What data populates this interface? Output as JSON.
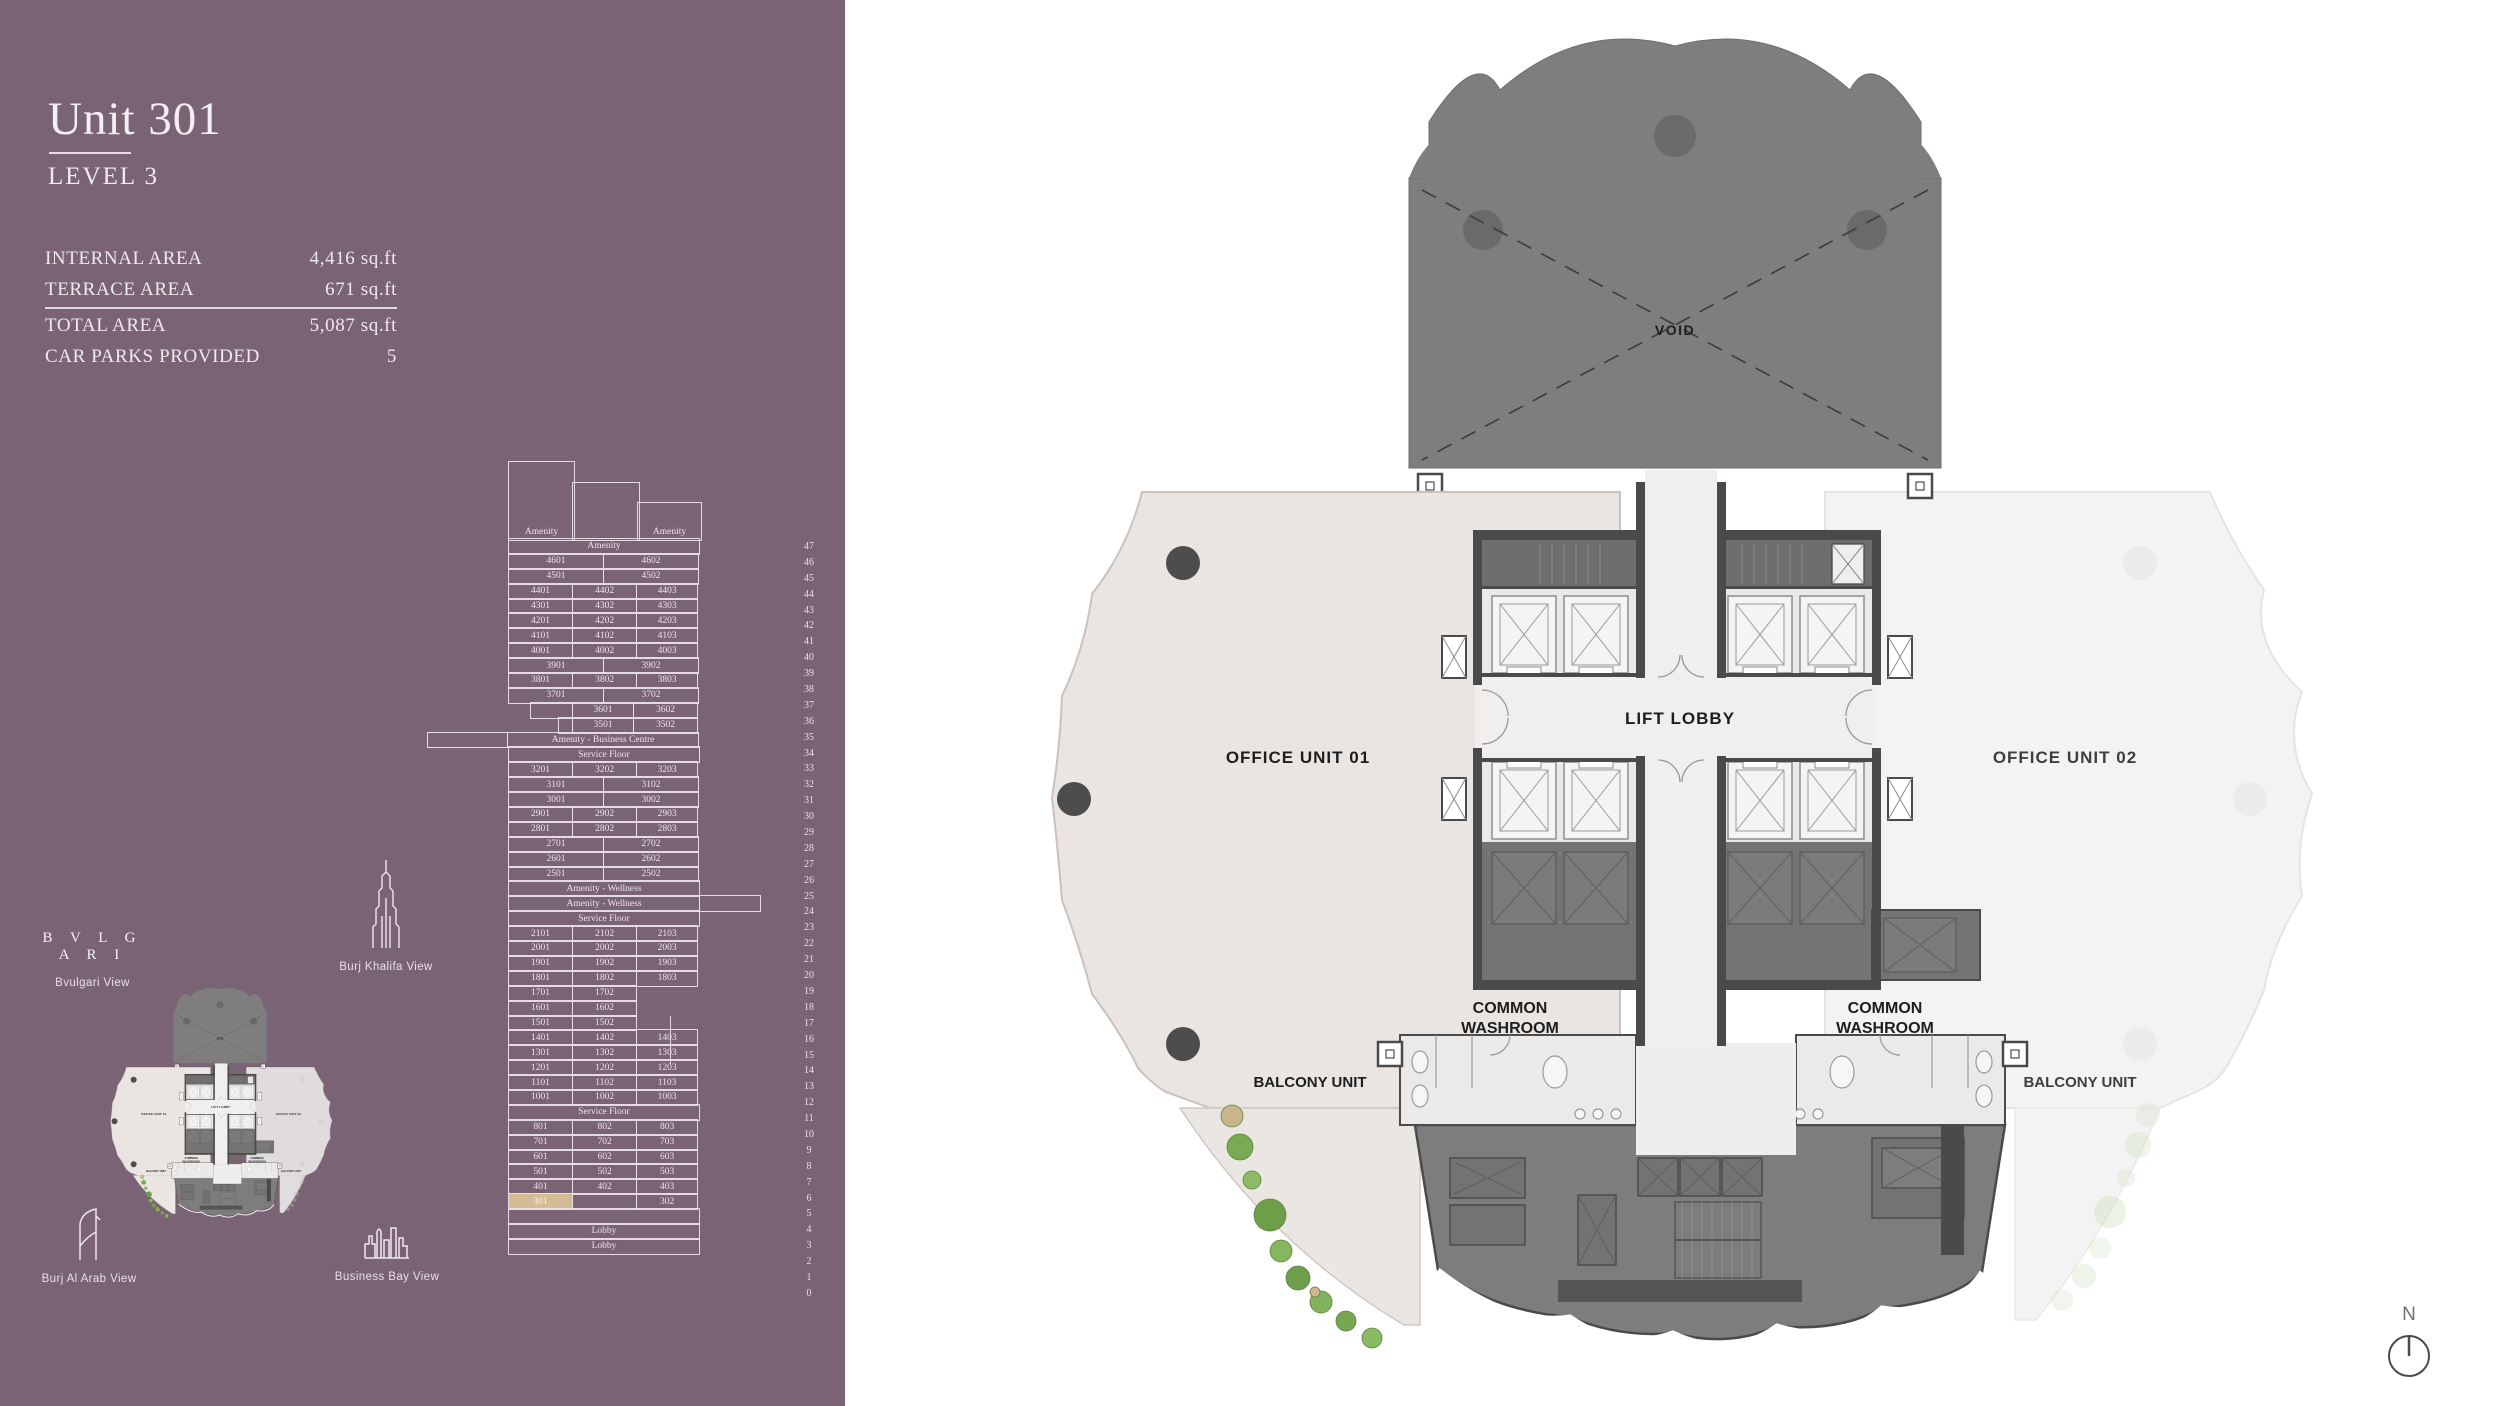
{
  "sidebar": {
    "bg_color": "#7a6374",
    "title": "Unit 301",
    "subtitle": "LEVEL 3",
    "stats": [
      {
        "label": "INTERNAL AREA",
        "value": "4,416 sq.ft"
      },
      {
        "label": "TERRACE AREA",
        "value": "671 sq.ft"
      },
      {
        "label": "TOTAL AREA",
        "value": "5,087 sq.ft"
      },
      {
        "label": "CAR PARKS PROVIDED",
        "value": "5"
      }
    ],
    "views": {
      "bvlgari_logo": "B V L G A R I",
      "bvlgari": "Bvulgari View",
      "burj_khalifa": "Burj Khalifa View",
      "burj_al_arab": "Burj Al Arab View",
      "business_bay": "Business Bay View"
    },
    "stack": {
      "highlight_color": "#d3bb95",
      "highlighted_unit": "301",
      "crown_left": "Amenity",
      "crown_right": "Amenity",
      "stub": {
        "x": 162,
        "from_row": 30,
        "rows": 3
      },
      "rows": [
        {
          "n": "47",
          "c": [
            {
              "t": "Amenity",
              "w": 100,
              "lb": 1
            }
          ]
        },
        {
          "n": "46",
          "c": [
            {
              "t": "4601",
              "w": 50
            },
            {
              "t": "4602",
              "w": 50
            }
          ]
        },
        {
          "n": "45",
          "c": [
            {
              "t": "4501",
              "w": 50
            },
            {
              "t": "4502",
              "w": 50
            }
          ]
        },
        {
          "n": "44",
          "c": [
            {
              "t": "4401",
              "w": 33.9
            },
            {
              "t": "4402",
              "w": 33.9
            },
            {
              "t": "4403",
              "w": 32.2
            }
          ]
        },
        {
          "n": "43",
          "c": [
            {
              "t": "4301",
              "w": 33.9
            },
            {
              "t": "4302",
              "w": 33.9
            },
            {
              "t": "4303",
              "w": 32.2
            }
          ]
        },
        {
          "n": "42",
          "c": [
            {
              "t": "4201",
              "w": 33.9
            },
            {
              "t": "4202",
              "w": 33.9
            },
            {
              "t": "4203",
              "w": 32.2
            }
          ]
        },
        {
          "n": "41",
          "c": [
            {
              "t": "4101",
              "w": 33.9
            },
            {
              "t": "4102",
              "w": 33.9
            },
            {
              "t": "4103",
              "w": 32.2
            }
          ]
        },
        {
          "n": "40",
          "c": [
            {
              "t": "4001",
              "w": 33.9
            },
            {
              "t": "4002",
              "w": 33.9
            },
            {
              "t": "4003",
              "w": 32.2
            }
          ]
        },
        {
          "n": "39",
          "c": [
            {
              "t": "3901",
              "w": 50
            },
            {
              "t": "3902",
              "w": 50
            }
          ]
        },
        {
          "n": "38",
          "c": [
            {
              "t": "3801",
              "w": 33.9
            },
            {
              "t": "3802",
              "w": 33.9
            },
            {
              "t": "3803",
              "w": 32.2
            }
          ]
        },
        {
          "n": "37",
          "c": [
            {
              "t": "3701",
              "w": 50
            },
            {
              "t": "3702",
              "w": 50
            }
          ]
        },
        {
          "n": "36",
          "ml": 22,
          "w": 170,
          "c": [
            {
              "t": "",
              "w": 25.3
            },
            {
              "t": "3601",
              "w": 36.5
            },
            {
              "t": "3602",
              "w": 38.2
            }
          ]
        },
        {
          "n": "35",
          "ml": 50,
          "w": 142,
          "c": [
            {
              "t": "",
              "w": 10.6
            },
            {
              "t": "3501",
              "w": 43.7
            },
            {
              "t": "3502",
              "w": 45.7
            }
          ]
        },
        {
          "n": "34",
          "ml": -81,
          "w": 273,
          "c": [
            {
              "t": "",
              "w": 29.7
            },
            {
              "t": "Amenity - Business Centre",
              "w": 70.3,
              "lb": 1
            }
          ]
        },
        {
          "n": "33",
          "c": [
            {
              "t": "Service Floor",
              "w": 100,
              "lb": 1
            }
          ]
        },
        {
          "n": "32",
          "c": [
            {
              "t": "3201",
              "w": 33.9
            },
            {
              "t": "3202",
              "w": 33.9
            },
            {
              "t": "3203",
              "w": 32.2
            }
          ]
        },
        {
          "n": "31",
          "c": [
            {
              "t": "3101",
              "w": 50
            },
            {
              "t": "3102",
              "w": 50
            }
          ]
        },
        {
          "n": "30",
          "c": [
            {
              "t": "3001",
              "w": 50
            },
            {
              "t": "3002",
              "w": 50
            }
          ]
        },
        {
          "n": "29",
          "c": [
            {
              "t": "2901",
              "w": 33.9
            },
            {
              "t": "2902",
              "w": 33.9
            },
            {
              "t": "2903",
              "w": 32.2
            }
          ]
        },
        {
          "n": "28",
          "c": [
            {
              "t": "2801",
              "w": 33.9
            },
            {
              "t": "2802",
              "w": 33.9
            },
            {
              "t": "2803",
              "w": 32.2
            }
          ]
        },
        {
          "n": "27",
          "c": [
            {
              "t": "2701",
              "w": 50
            },
            {
              "t": "2702",
              "w": 50
            }
          ]
        },
        {
          "n": "26",
          "c": [
            {
              "t": "2601",
              "w": 50
            },
            {
              "t": "2602",
              "w": 50
            }
          ]
        },
        {
          "n": "25",
          "c": [
            {
              "t": "2501",
              "w": 50
            },
            {
              "t": "2502",
              "w": 50
            }
          ]
        },
        {
          "n": "24",
          "c": [
            {
              "t": "Amenity - Wellness",
              "w": 100,
              "lb": 1
            }
          ]
        },
        {
          "n": "23",
          "w": 254,
          "c": [
            {
              "t": "Amenity - Wellness",
              "w": 75.6,
              "lb": 1
            },
            {
              "t": "",
              "w": 24.4
            }
          ]
        },
        {
          "n": "22",
          "c": [
            {
              "t": "Service Floor",
              "w": 100,
              "lb": 1
            }
          ]
        },
        {
          "n": "21",
          "c": [
            {
              "t": "2101",
              "w": 33.9
            },
            {
              "t": "2102",
              "w": 33.9
            },
            {
              "t": "2103",
              "w": 32.2
            }
          ]
        },
        {
          "n": "20",
          "c": [
            {
              "t": "2001",
              "w": 33.9
            },
            {
              "t": "2002",
              "w": 33.9
            },
            {
              "t": "2003",
              "w": 32.2
            }
          ]
        },
        {
          "n": "19",
          "c": [
            {
              "t": "1901",
              "w": 33.9
            },
            {
              "t": "1902",
              "w": 33.9
            },
            {
              "t": "1903",
              "w": 32.2
            }
          ]
        },
        {
          "n": "18",
          "c": [
            {
              "t": "1801",
              "w": 33.9
            },
            {
              "t": "1802",
              "w": 33.9
            },
            {
              "t": "1803",
              "w": 32.2
            }
          ]
        },
        {
          "n": "17",
          "w": 130,
          "c": [
            {
              "t": "1701",
              "w": 50
            },
            {
              "t": "1702",
              "w": 50
            }
          ]
        },
        {
          "n": "16",
          "w": 130,
          "c": [
            {
              "t": "1601",
              "w": 50
            },
            {
              "t": "1602",
              "w": 50
            }
          ]
        },
        {
          "n": "15",
          "w": 130,
          "c": [
            {
              "t": "1501",
              "w": 50
            },
            {
              "t": "1502",
              "w": 50
            }
          ]
        },
        {
          "n": "14",
          "c": [
            {
              "t": "1401",
              "w": 33.9
            },
            {
              "t": "1402",
              "w": 33.9
            },
            {
              "t": "1403",
              "w": 32.2
            }
          ]
        },
        {
          "n": "13",
          "c": [
            {
              "t": "1301",
              "w": 33.9
            },
            {
              "t": "1302",
              "w": 33.9
            },
            {
              "t": "1303",
              "w": 32.2
            }
          ]
        },
        {
          "n": "12",
          "c": [
            {
              "t": "1201",
              "w": 33.9
            },
            {
              "t": "1202",
              "w": 33.9
            },
            {
              "t": "1203",
              "w": 32.2
            }
          ]
        },
        {
          "n": "11",
          "c": [
            {
              "t": "1101",
              "w": 33.9
            },
            {
              "t": "1102",
              "w": 33.9
            },
            {
              "t": "1103",
              "w": 32.2
            }
          ]
        },
        {
          "n": "10",
          "c": [
            {
              "t": "1001",
              "w": 33.9
            },
            {
              "t": "1002",
              "w": 33.9
            },
            {
              "t": "1003",
              "w": 32.2
            }
          ]
        },
        {
          "n": "9",
          "c": [
            {
              "t": "Service Floor",
              "w": 100,
              "lb": 1
            }
          ]
        },
        {
          "n": "8",
          "c": [
            {
              "t": "801",
              "w": 33.9
            },
            {
              "t": "802",
              "w": 33.9
            },
            {
              "t": "803",
              "w": 32.2
            }
          ]
        },
        {
          "n": "7",
          "c": [
            {
              "t": "701",
              "w": 33.9
            },
            {
              "t": "702",
              "w": 33.9
            },
            {
              "t": "703",
              "w": 32.2
            }
          ]
        },
        {
          "n": "6",
          "c": [
            {
              "t": "601",
              "w": 33.9
            },
            {
              "t": "602",
              "w": 33.9
            },
            {
              "t": "603",
              "w": 32.2
            }
          ]
        },
        {
          "n": "5",
          "c": [
            {
              "t": "501",
              "w": 33.9
            },
            {
              "t": "502",
              "w": 33.9
            },
            {
              "t": "503",
              "w": 32.2
            }
          ]
        },
        {
          "n": "4",
          "c": [
            {
              "t": "401",
              "w": 33.9
            },
            {
              "t": "402",
              "w": 33.9
            },
            {
              "t": "403",
              "w": 32.2
            }
          ]
        },
        {
          "n": "3",
          "c": [
            {
              "t": "301",
              "w": 33.9,
              "hl": 1
            },
            {
              "t": "",
              "w": 33.9
            },
            {
              "t": "302",
              "w": 32.2
            }
          ]
        },
        {
          "n": "2",
          "c": [
            {
              "t": "",
              "w": 100
            }
          ]
        },
        {
          "n": "1",
          "c": [
            {
              "t": "Lobby",
              "w": 100,
              "lb": 1
            }
          ]
        },
        {
          "n": "0",
          "c": [
            {
              "t": "Lobby",
              "w": 100,
              "lb": 1
            }
          ]
        }
      ]
    }
  },
  "plan": {
    "void_label": "VOID",
    "office1": "OFFICE UNIT 01",
    "office2": "OFFICE UNIT 02",
    "lift_lobby": "LIFT LOBBY",
    "washroom_line1": "COMMON",
    "washroom_line2": "WASHROOM",
    "balcony_left": "BALCONY UNIT",
    "balcony_right": "BALCONY UNIT",
    "compass_n": "N",
    "colors": {
      "wall": "#4b4a4a",
      "void_fill": "#7f7d7e",
      "office1_fill": "#eae5e1",
      "office2_fill": "#f2f1f0",
      "lobby_fill": "#f0efee",
      "service_fill": "#7e7d7d",
      "landscape_green": "#7aaa54",
      "highlight_tan": "#d3bb95"
    }
  }
}
